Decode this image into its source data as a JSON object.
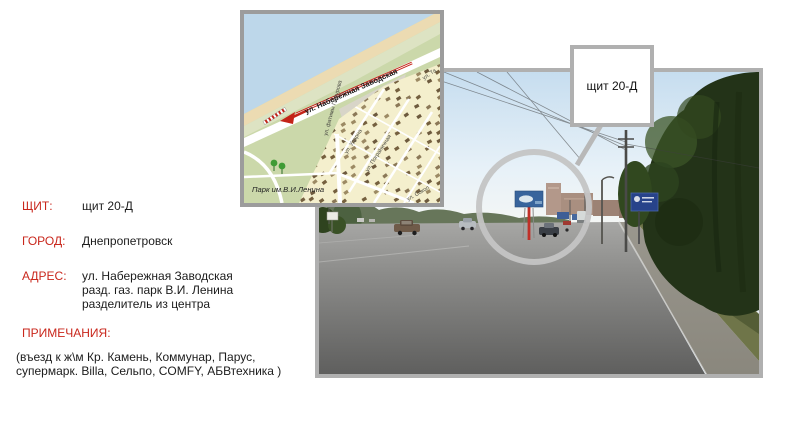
{
  "info": {
    "label_color": "#c9271c",
    "shield": {
      "label": "ЩИТ:",
      "value": "щит 20-Д"
    },
    "city": {
      "label": "ГОРОД:",
      "value": "Днепропетровск"
    },
    "address": {
      "label": "АДРЕС:",
      "line1": "ул. Набережная Заводская",
      "line2": "разд. газ. парк В.И. Ленина",
      "line3": "разделитель из центра"
    },
    "notes": {
      "label": "ПРИМЕЧАНИЯ:",
      "line1": "(въезд к ж\\м Кр. Камень, Коммунар, Парус,",
      "line2": "супермарк. Billa, Сельпо, COMFY, АБВтехника )"
    }
  },
  "callout": {
    "label": "щит 20-Д"
  },
  "map": {
    "main_street": "ул. Набережная Заводская",
    "park": "Парк им.В.И.Ленина",
    "streets": {
      "s1": "ул. Ударна",
      "s2": "ул. Пограничная",
      "s3": "ул. фатимы Гафурова",
      "s4": "ул. Сокол",
      "s5": "ул. Та"
    },
    "colors": {
      "water": "#bdd7ea",
      "sand": "#ecdbb2",
      "land": "#cbd8aa",
      "residential": "#f4efcd",
      "building": "#8b7857",
      "marker_red": "#c42318"
    }
  },
  "photo": {
    "colors": {
      "sky_top": "#c6ddef",
      "road": "#8f8f8d",
      "trees_dark": "#233318",
      "highlight_ring": "#c4c4c4",
      "billboard_face": "#38649c",
      "billboard_pole": "#c03028"
    }
  }
}
